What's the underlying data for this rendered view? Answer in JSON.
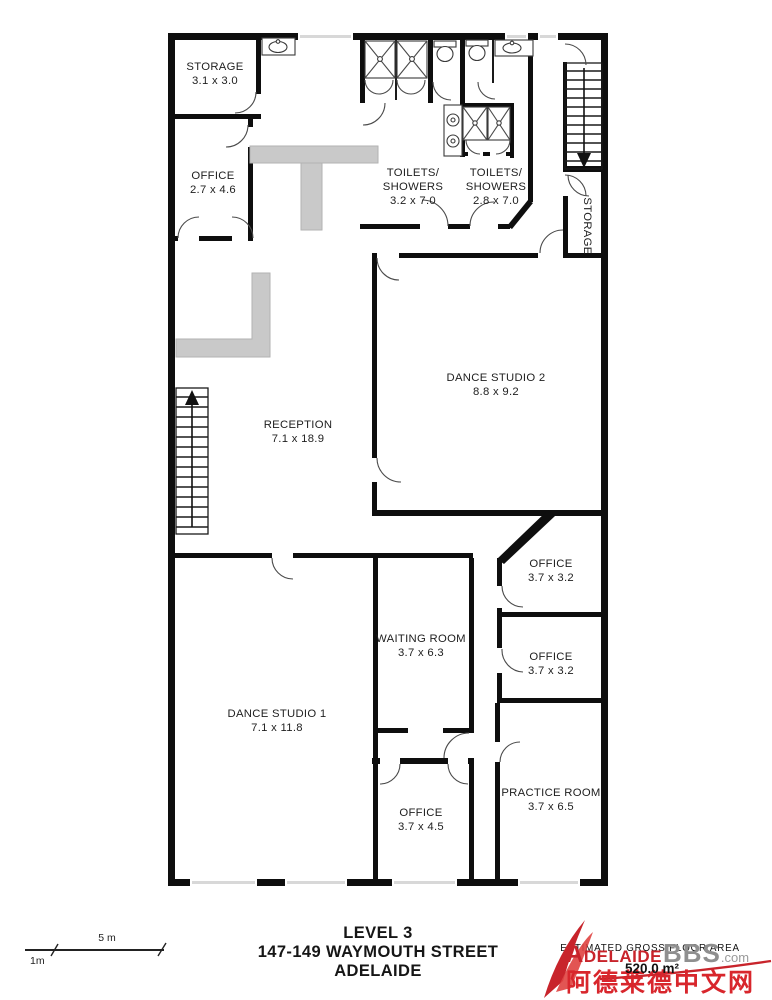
{
  "rooms": {
    "storage_top": {
      "name": "STORAGE",
      "dims": "3.1 x 3.0"
    },
    "office_top": {
      "name": "OFFICE",
      "dims": "2.7 x 4.6"
    },
    "toilets_1": {
      "name1": "TOILETS/",
      "name2": "SHOWERS",
      "dims": "3.2 x 7.0"
    },
    "toilets_2": {
      "name1": "TOILETS/",
      "name2": "SHOWERS",
      "dims": "2.8 x 7.0"
    },
    "storage_side": {
      "name": "STORAGE"
    },
    "reception": {
      "name": "RECEPTION",
      "dims": "7.1 x 18.9"
    },
    "dance_studio_2": {
      "name": "DANCE STUDIO 2",
      "dims": "8.8 x 9.2"
    },
    "office_r1": {
      "name": "OFFICE",
      "dims": "3.7 x 3.2"
    },
    "office_r2": {
      "name": "OFFICE",
      "dims": "3.7 x 3.2"
    },
    "waiting_room": {
      "name": "WAITING ROOM",
      "dims": "3.7 x 6.3"
    },
    "dance_studio_1": {
      "name": "DANCE STUDIO 1",
      "dims": "7.1 x 11.8"
    },
    "office_bottom": {
      "name": "OFFICE",
      "dims": "3.7 x 4.5"
    },
    "practice_room": {
      "name": "PRACTICE ROOM",
      "dims": "3.7 x 6.5"
    }
  },
  "title": {
    "line1": "LEVEL 3",
    "line2": "147-149 WAYMOUTH STREET",
    "line3": "ADELAIDE"
  },
  "area": {
    "label": "ESTIMATED GROSS FLOOR AREA",
    "value": "520.0 m²"
  },
  "watermark": {
    "brand_main": "Adelaide",
    "brand_suffix": "BBS",
    "brand_tld": ".com",
    "brand_cn": "阿德莱德中文网",
    "red": "#c8242b",
    "gray": "#8f8f8f"
  },
  "scale_bar": {
    "label_5m": "5 m",
    "label_1m": "1m"
  }
}
